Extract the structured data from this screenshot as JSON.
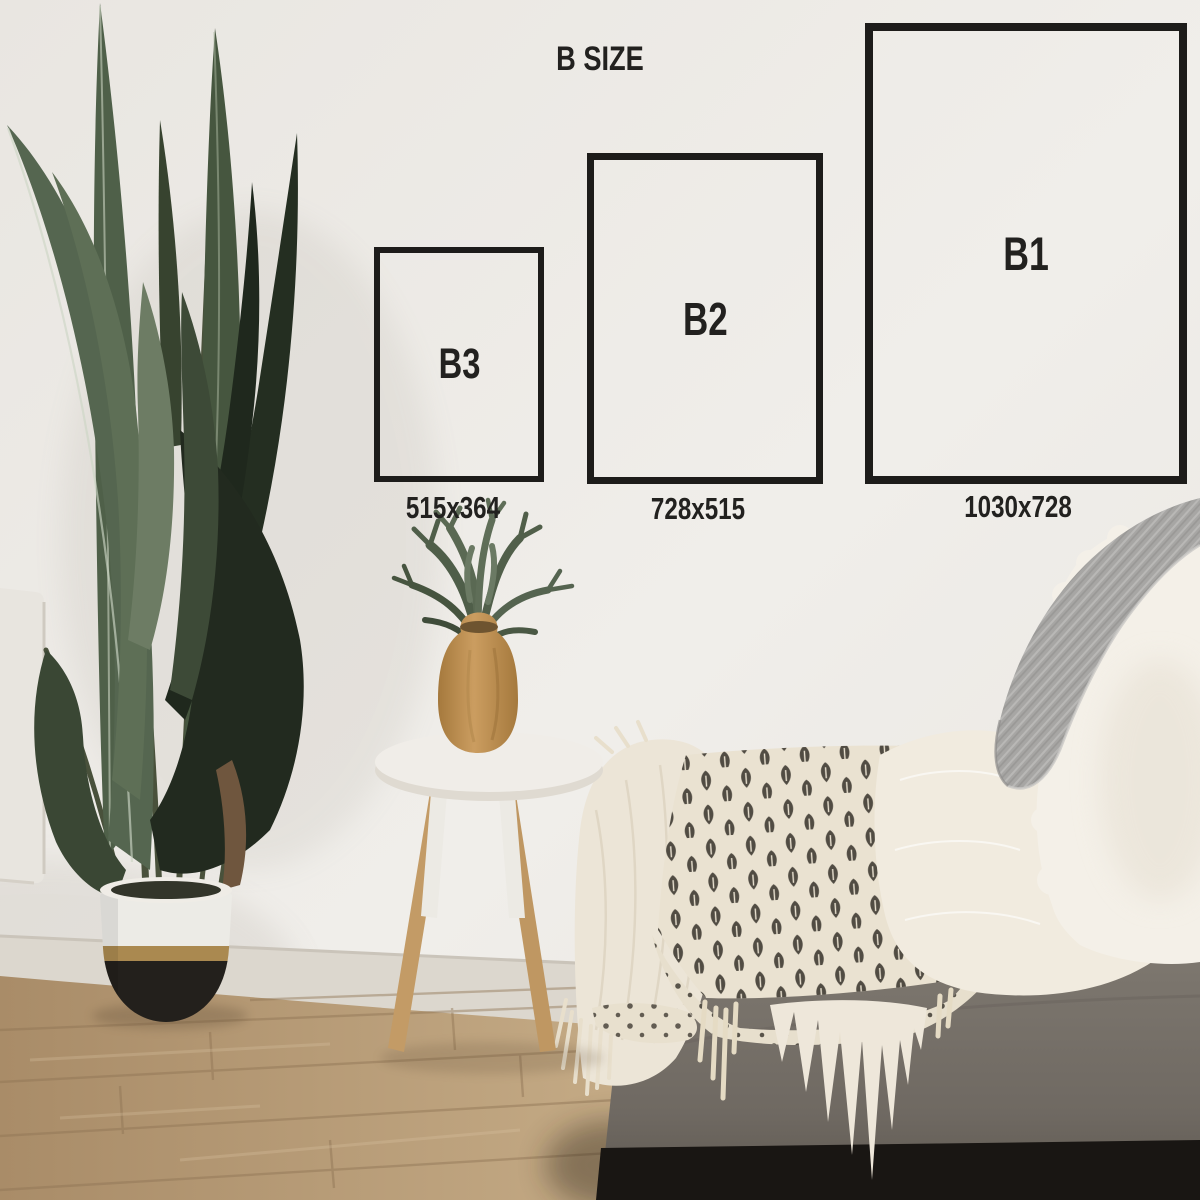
{
  "title": "B SIZE",
  "sizes": [
    {
      "id": "b1",
      "label": "B1",
      "dimensions": "1030x728"
    },
    {
      "id": "b2",
      "label": "B2",
      "dimensions": "728x515"
    },
    {
      "id": "b3",
      "label": "B3",
      "dimensions": "515x364"
    }
  ],
  "scene_objects": [
    "bird-of-paradise-plant",
    "white-gold-black-planter-pot",
    "white-tripod-side-table",
    "wooden-vase-with-fern",
    "gray-couch",
    "block-print-throw-blanket",
    "cream-muslin-blanket",
    "white-fur-throw",
    "sherpa-pillow",
    "gray-knit-blanket",
    "wood-floor",
    "white-wall",
    "white-cabinet"
  ],
  "palette": {
    "wall": "#e9e6e1",
    "wall-bright": "#f0eeea",
    "wall-shade": "#d9d4cc",
    "baseboard": "#dcd7ce",
    "floor-light": "#c3a984",
    "floor-dark": "#a98c68",
    "plank": "#8f7454",
    "cabinet": "#e8e5df",
    "leaf-light": "#6d7c64",
    "leaf-mid": "#556650",
    "leaf-mid2": "#4f6049",
    "leaf-deep": "#46563f",
    "leaf-front": "#3d4a37",
    "leaf-dark": "#242e21",
    "leaf-darker": "#1f281d",
    "stem": "#49513b",
    "dried": "#6f563e",
    "pot-white": "#ecebe6",
    "pot-gold": "#aa8950",
    "pot-black": "#23201c",
    "stool-top": "#f0ede8",
    "leg-white": "#eceae4",
    "leg-wood": "#c39b66",
    "vase-light": "#cb9d60",
    "vase-dark": "#a5793d",
    "vase-plant": "#55644e",
    "couch": "#868077",
    "couch-dark": "#6f6962",
    "couch-base": "#191613",
    "muslin": "#ece5d7",
    "throw-cream": "#eae2d1",
    "throw-fold": "#e7dfcd",
    "motif": "#403b33",
    "fur": "#f1ebdf",
    "sherpa": "#f4f0e8",
    "knit": "#a7a6a4",
    "knit-light": "#b9b8b6",
    "frame": "#1d1c1a",
    "text": "#22211f"
  }
}
